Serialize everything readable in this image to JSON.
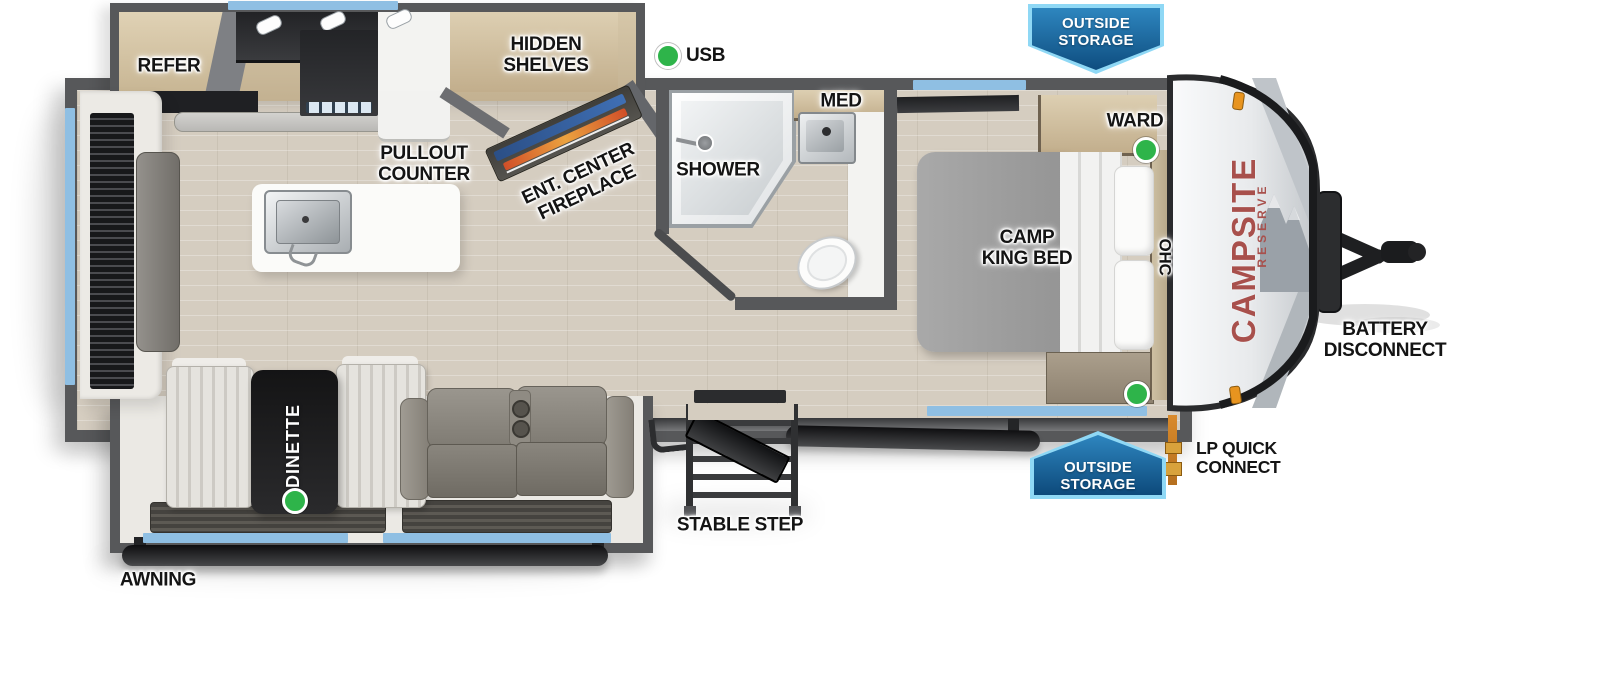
{
  "diagram": {
    "type": "travel trailer floor plan",
    "brand": {
      "primary": "CAMPSITE",
      "secondary": "RESERVE",
      "color": "#a8504c"
    },
    "badges": {
      "top": {
        "line1": "OUTSIDE",
        "line2": "STORAGE"
      },
      "bottom": {
        "line1": "OUTSIDE",
        "line2": "STORAGE"
      }
    },
    "labels": {
      "refer": "REFER",
      "hidden_shelves": {
        "line1": "HIDDEN",
        "line2": "SHELVES"
      },
      "usb": "USB",
      "pullout_counter": {
        "line1": "PULLOUT",
        "line2": "COUNTER"
      },
      "ent_center_fireplace": {
        "line1": "ENT. CENTER",
        "line2": "FIREPLACE"
      },
      "shower": "SHOWER",
      "med": "MED",
      "camp_king_bed": {
        "line1": "CAMP",
        "line2": "KING BED"
      },
      "ward": "WARD",
      "ohc": "OHC",
      "dinette": "DINETTE",
      "stable_step": "STABLE STEP",
      "awning": "AWNING",
      "battery_disconnect": {
        "line1": "BATTERY",
        "line2": "DISCONNECT"
      },
      "lp_quick_connect": {
        "line1": "LP QUICK",
        "line2": "CONNECT"
      }
    },
    "indicators": {
      "count": 4,
      "color": "#2eb44a",
      "locations": [
        "usb",
        "wardrobe",
        "bed-front",
        "dinette"
      ]
    },
    "colors": {
      "wall": "#57585a",
      "window": "#8fbfe3",
      "floor": "#d5cdc0",
      "badge_fill": "#2e86bf",
      "badge_border": "#8fd8f5",
      "fireplace_blue": "#3f6fb4",
      "fireplace_flame": "#eba23f",
      "brand_red": "#a8504c"
    }
  }
}
